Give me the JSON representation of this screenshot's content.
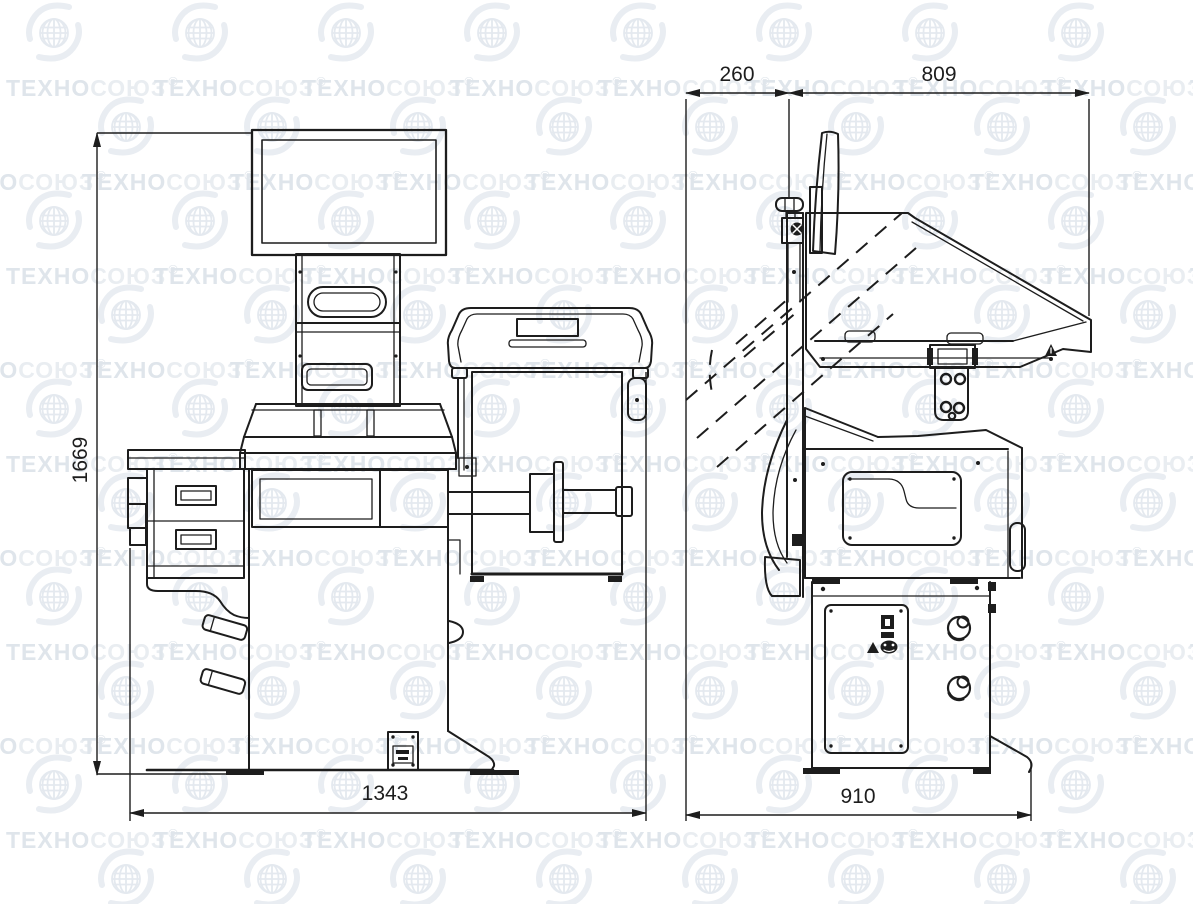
{
  "watermark": {
    "brand_part1": "ТЕХНО",
    "brand_part2": "СОЮЗ",
    "registered_symbol": "®",
    "colors": {
      "text_primary": "#dfe5eb",
      "text_secondary": "#e9edf1",
      "registered": "#e4e9ee",
      "globe_grid": "#e4e9ef",
      "swoosh": "#e9edf2"
    }
  },
  "drawing": {
    "ink_color": "#1d1d1d",
    "background_color": "#ffffff",
    "front_view": {
      "height_dim": "1669",
      "width_dim": "1343"
    },
    "side_view": {
      "monitor_offset_dim": "260",
      "guard_depth_dim": "809",
      "base_depth_dim": "910"
    }
  }
}
